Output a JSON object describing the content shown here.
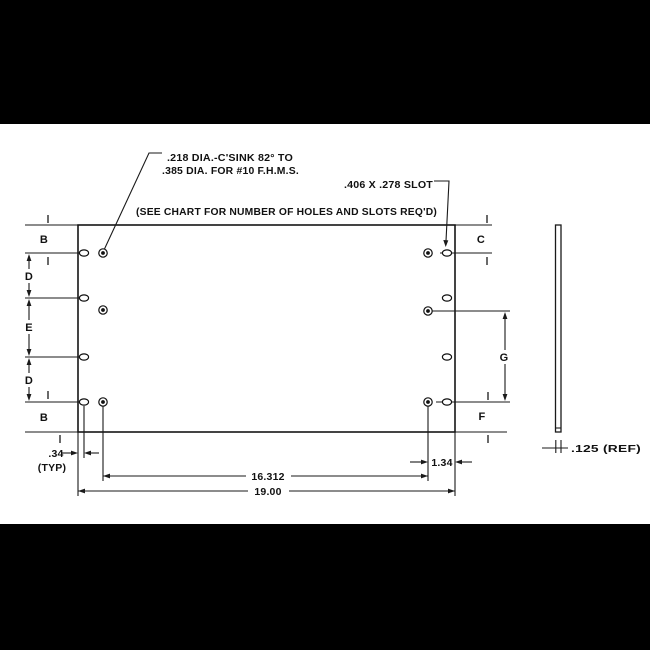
{
  "colors": {
    "letterbox": "#000000",
    "paper": "#ffffff",
    "ink": "#1a1a1a"
  },
  "notes": {
    "countersink_1": ".218 DIA.-C'SINK 82° TO",
    "countersink_2": ".385 DIA. FOR #10 F.H.M.S.",
    "slot": ".406 X .278 SLOT",
    "chart": "(SEE CHART FOR NUMBER OF HOLES AND SLOTS REQ'D)",
    "thickness": ".125 (REF)"
  },
  "labels": {
    "b_top": "B",
    "c": "C",
    "d_upper": "D",
    "e": "E",
    "d_lower": "D",
    "b_bottom": "B",
    "f": "F",
    "g": "G"
  },
  "dims": {
    "edge_offset": ".34",
    "edge_offset_qual": "(TYP)",
    "slot_to_edge": "1.34",
    "hole_span": "16.312",
    "overall_width": "19.00"
  }
}
